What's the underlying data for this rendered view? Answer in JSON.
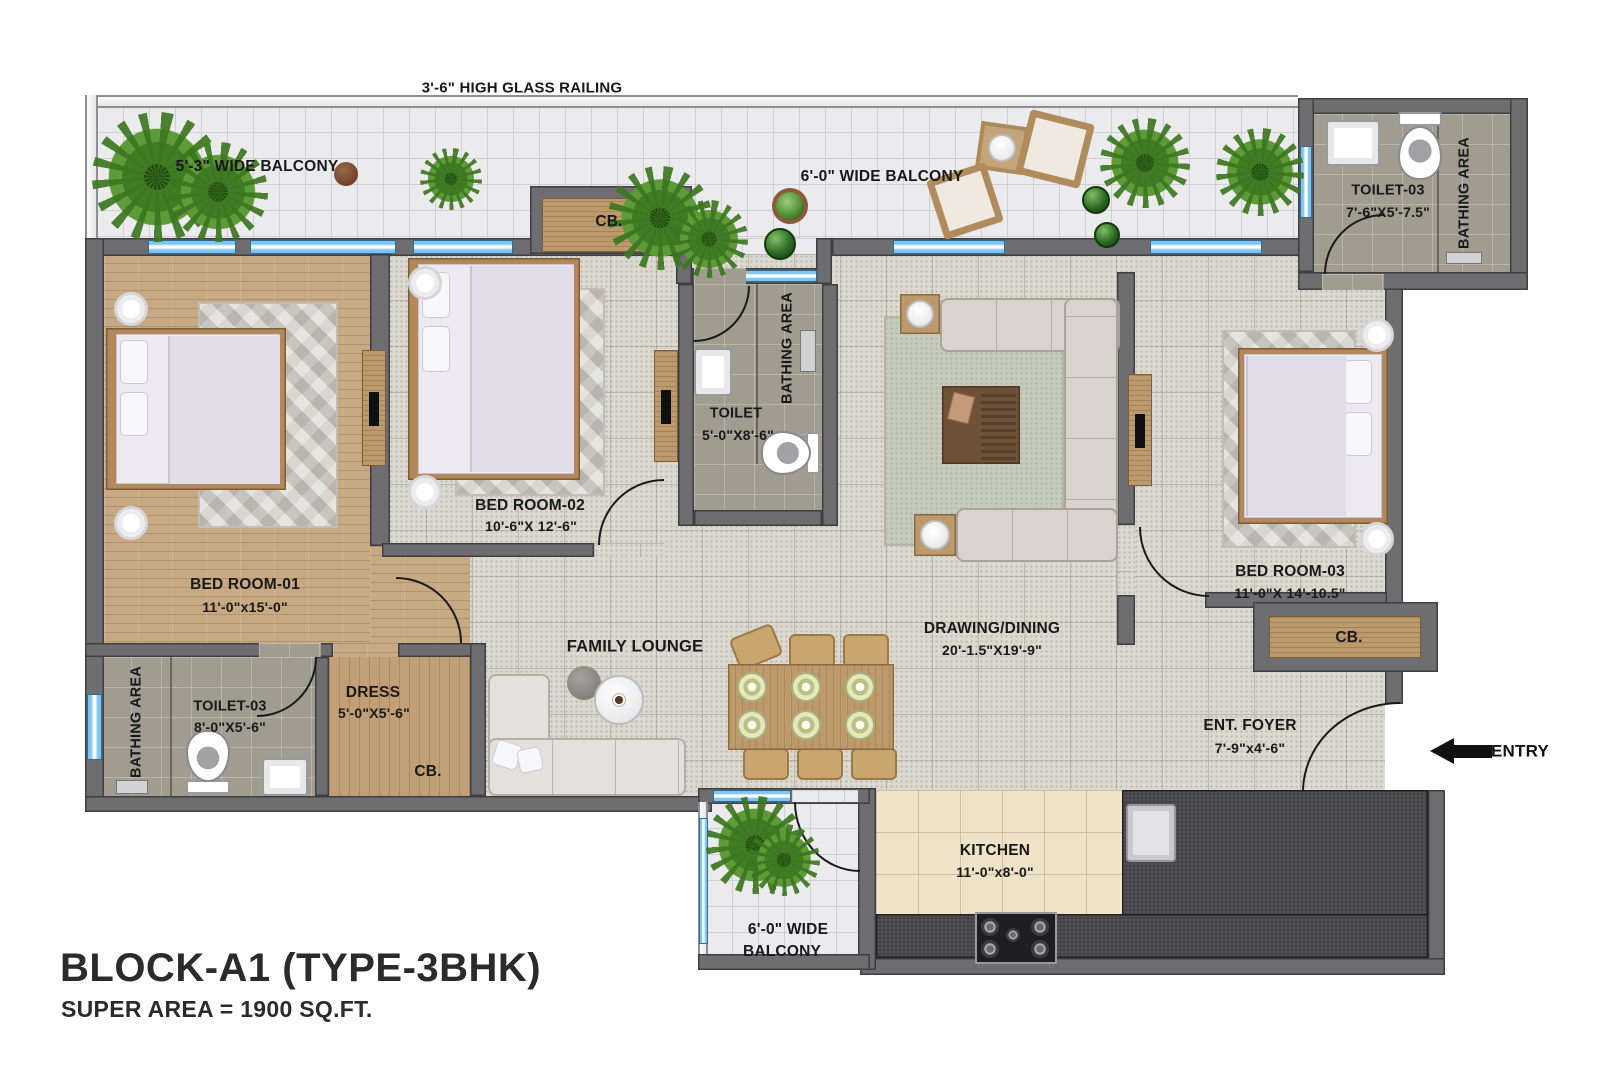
{
  "palette": {
    "wall": "#6e6e70",
    "window_glass": "#7fc4ee",
    "wood_floor": "#c7a983",
    "tile_floor": "#dcd9d1",
    "bath_floor": "#a09c90",
    "kitchen_floor": "#eee3c8",
    "counter": "#46464a",
    "plant_green": "#3f7c23",
    "text": "#191919"
  },
  "title": {
    "line1": "BLOCK-A1 (TYPE-3BHK)",
    "line2": "SUPER AREA = 1900 SQ.FT."
  },
  "annotations": {
    "railing": "3'-6\"  HIGH GLASS RAILING",
    "entry": "ENTRY"
  },
  "rooms": {
    "balcony_top_left": {
      "label": "5'-3\" WIDE BALCONY"
    },
    "balcony_top_right": {
      "label": "6'-0\" WIDE BALCONY"
    },
    "toilet_top_right": {
      "name": "TOILET-03",
      "dims": "7'-6\"X5'-7.5\"",
      "area": "BATHING AREA"
    },
    "cb_top": {
      "label": "CB."
    },
    "bedroom1": {
      "name": "BED ROOM-01",
      "dims": "11'-0\"x15'-0\""
    },
    "bedroom2": {
      "name": "BED ROOM-02",
      "dims": "10'-6\"X 12'-6\""
    },
    "toilet_center": {
      "name": "TOILET",
      "dims": "5'-0\"X8'-6\"",
      "area": "BATHING AREA"
    },
    "drawing_dining": {
      "name": "DRAWING/DINING",
      "dims": "20'-1.5\"X19'-9\""
    },
    "bedroom3": {
      "name": "BED ROOM-03",
      "dims": "11'-0\"X 14'-10.5\"",
      "cb": "CB."
    },
    "toilet_bottom_left": {
      "name": "TOILET-03",
      "dims": "8'-0\"X5'-6\"",
      "area": "BATHING AREA"
    },
    "dress": {
      "name": "DRESS",
      "dims": "5'-0\"X5'-6\"",
      "cb": "CB."
    },
    "family_lounge": {
      "name": "FAMILY LOUNGE"
    },
    "ent_foyer": {
      "name": "ENT. FOYER",
      "dims": "7'-9\"x4'-6\""
    },
    "kitchen": {
      "name": "KITCHEN",
      "dims": "11'-0\"x8'-0\""
    },
    "balcony_bottom": {
      "line1": "6'-0\" WIDE",
      "line2": "BALCONY"
    }
  }
}
